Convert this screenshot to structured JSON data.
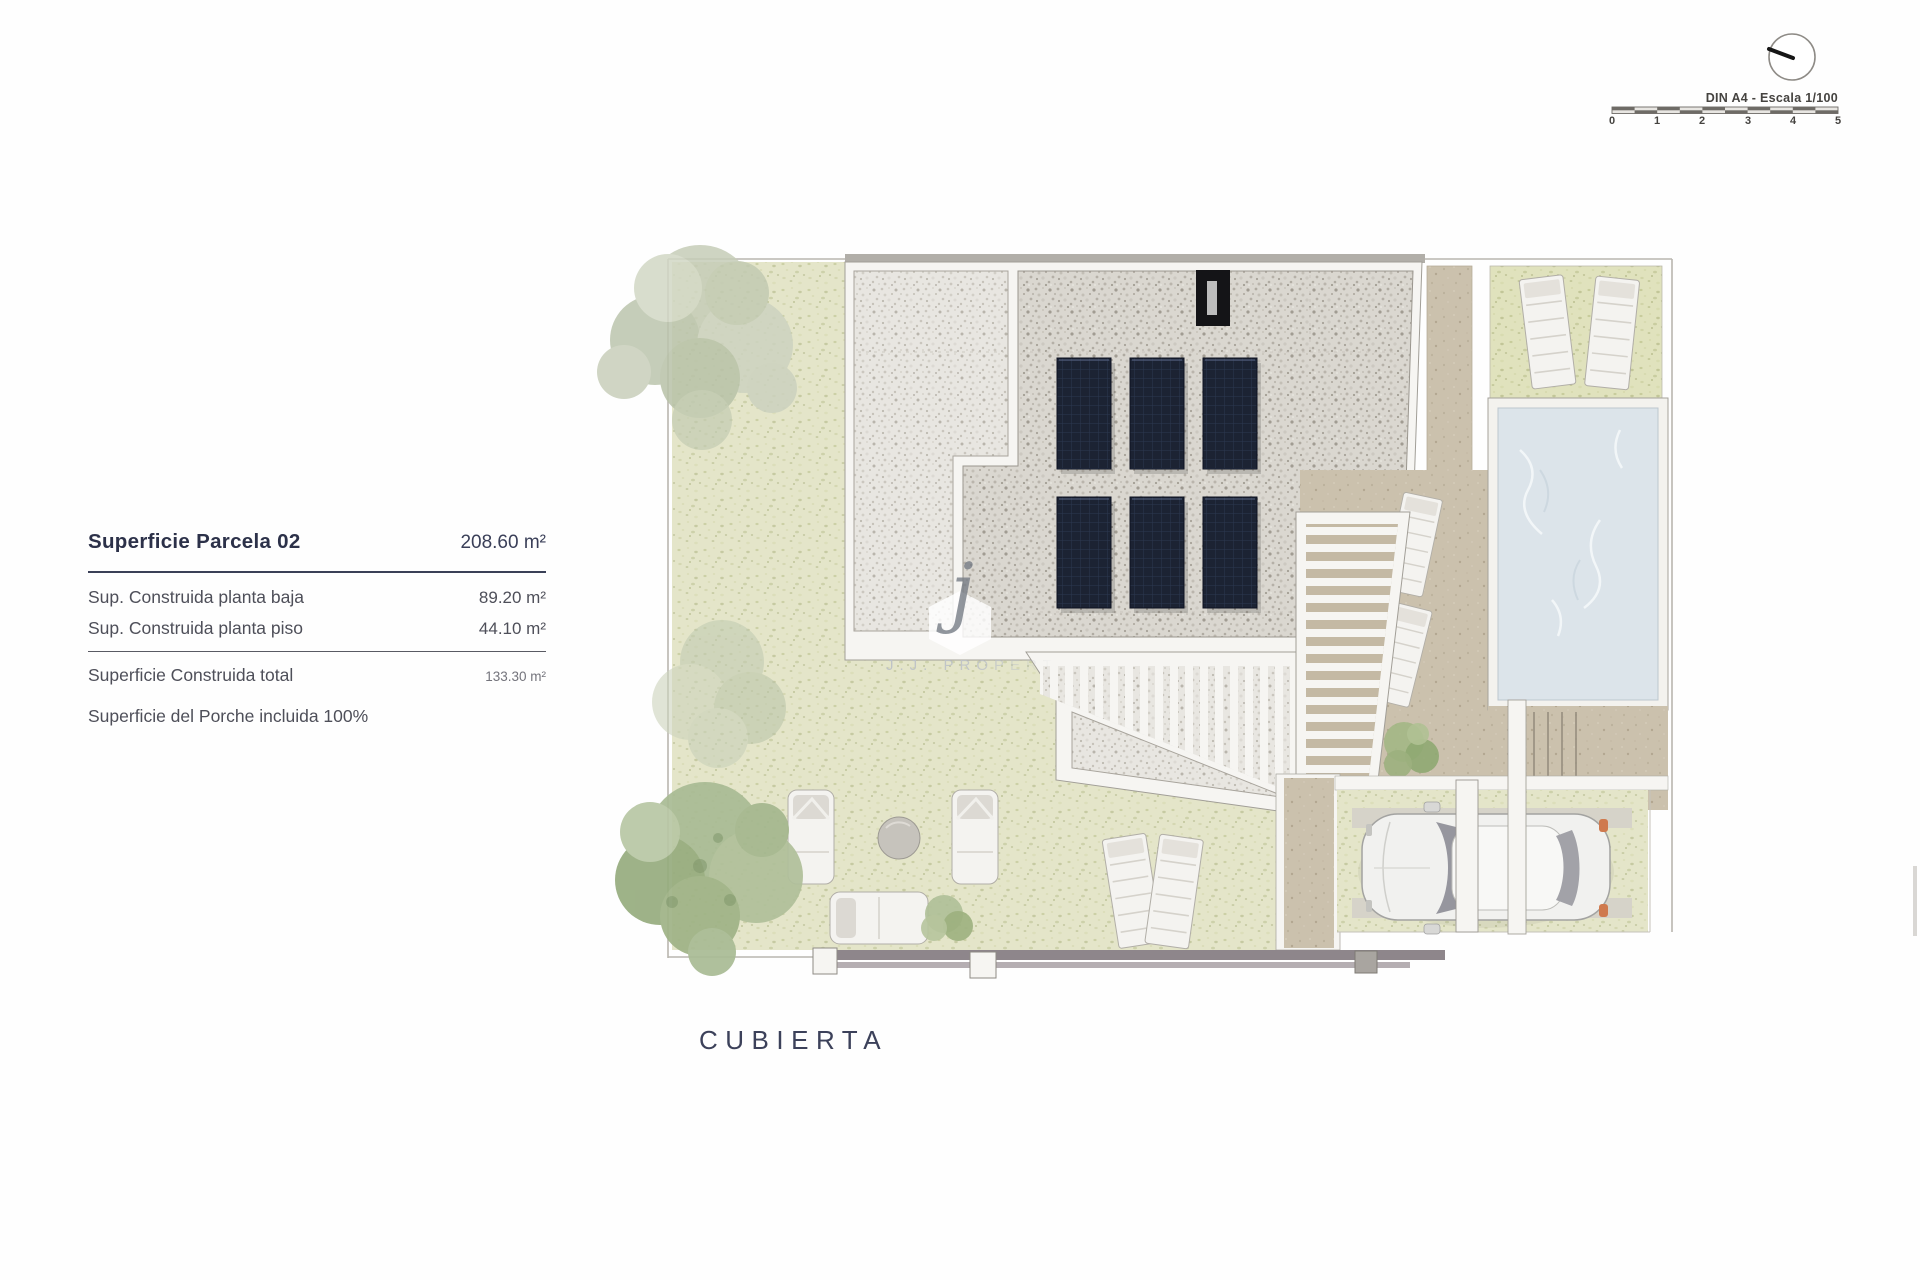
{
  "sheet": {
    "title": "CUBIERTA"
  },
  "panel": {
    "title": "Superficie Parcela 02",
    "title_value": "208.60 m²",
    "rows": [
      {
        "label": "Sup. Construida planta baja",
        "value": "89.20 m²"
      },
      {
        "label": "Sup. Construida planta piso",
        "value": "44.10 m²"
      }
    ],
    "total": {
      "label": "Superficie Construida total",
      "value": "133.30 m²"
    },
    "note": "Superficie del Porche incluida 100%"
  },
  "scale": {
    "label": "DIN A4 - Escala 1/100",
    "ticks": [
      "0",
      "1",
      "2",
      "3",
      "4",
      "5"
    ]
  },
  "watermark": {
    "logo_letter": "j",
    "text": "J.J. PROPERTIES"
  },
  "colors": {
    "text_navy": "#2c3149",
    "text_gray": "#4e4f59",
    "grass": "#e4e5c9",
    "gravel_light": "#e8e6e1",
    "gravel_dark": "#dad7d0",
    "solar_panel": "#1c2333",
    "pool_water": "#dce4ea",
    "deck_tan": "#cbc1ad",
    "wall_gray": "#8e868b",
    "tree_green": "#a9bb94",
    "white_frame": "#f6f5f2"
  }
}
